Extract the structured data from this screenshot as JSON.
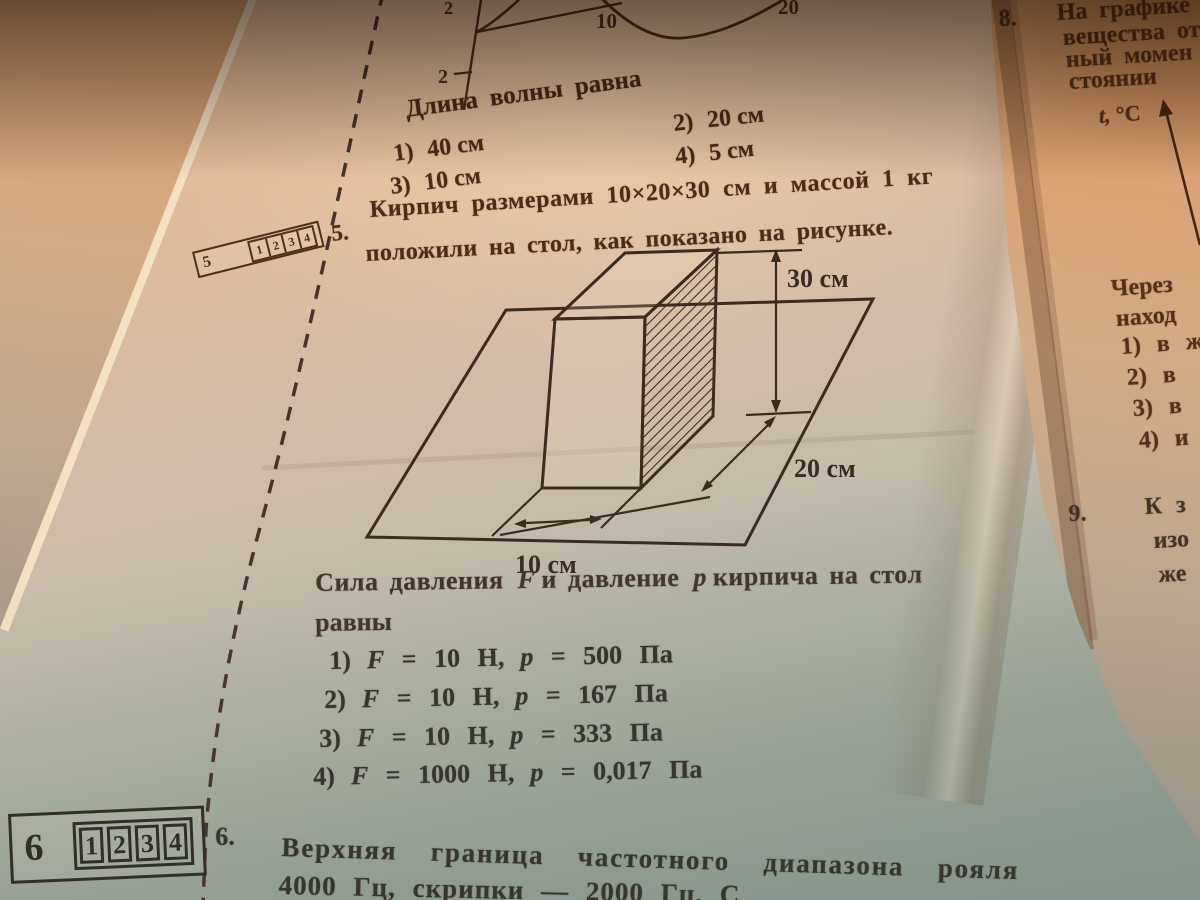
{
  "left_page": {
    "wave_graph": {
      "y_top_label": "2",
      "y_bottom_label": "2",
      "x_labels": [
        "10",
        "20"
      ]
    },
    "wave_question": {
      "prompt": "Длина волны равна",
      "options": [
        {
          "n": "1)",
          "v": "40 см"
        },
        {
          "n": "2)",
          "v": "20 см"
        },
        {
          "n": "3)",
          "v": "10 см"
        },
        {
          "n": "4)",
          "v": "5 см"
        }
      ]
    },
    "q5": {
      "number": "5.",
      "line1": "Кирпич размерами 10×20×30 см и массой 1 кг",
      "line2": "положили на стол, как показано на рисунке.",
      "diagram": {
        "height": "30 см",
        "depth": "20 см",
        "width": "10 см"
      },
      "prompt": {
        "a": "Сила давления",
        "f": "F",
        "b": "и давление",
        "p": "p",
        "c": "кирпича на стол",
        "d": "равны"
      },
      "options": [
        {
          "n": "1)",
          "f": "F = 10 Н,",
          "p": "p = 500 Па"
        },
        {
          "n": "2)",
          "f": "F = 10 Н,",
          "p": "p = 167 Па"
        },
        {
          "n": "3)",
          "f": "F = 10 Н,",
          "p": "p = 333 Па"
        },
        {
          "n": "4)",
          "f": "F = 1000 Н,",
          "p": "p = 0,017 Па"
        }
      ]
    },
    "q6": {
      "number": "6.",
      "line1": "Верхняя граница частотного диапазона рояля",
      "line2": "4000 Гц, скрипки — 2000 Гц. С"
    },
    "answer_boxes": [
      {
        "q": "5",
        "cells": [
          "1",
          "2",
          "3",
          "4"
        ]
      },
      {
        "q": "6",
        "cells": [
          "1",
          "2",
          "3",
          "4"
        ]
      }
    ]
  },
  "right_page": {
    "q8": {
      "number": "8.",
      "lines": [
        "На графике",
        "вещества от",
        "ный момен",
        "стоянии"
      ],
      "axis_label": "t, °C",
      "cont_lines": [
        "Через",
        "наход"
      ],
      "options": [
        "1) в ж",
        "2) в",
        "3) в",
        "4) и"
      ]
    },
    "q9": {
      "number": "9.",
      "lines": [
        "К з",
        "изо",
        "же"
      ]
    }
  }
}
